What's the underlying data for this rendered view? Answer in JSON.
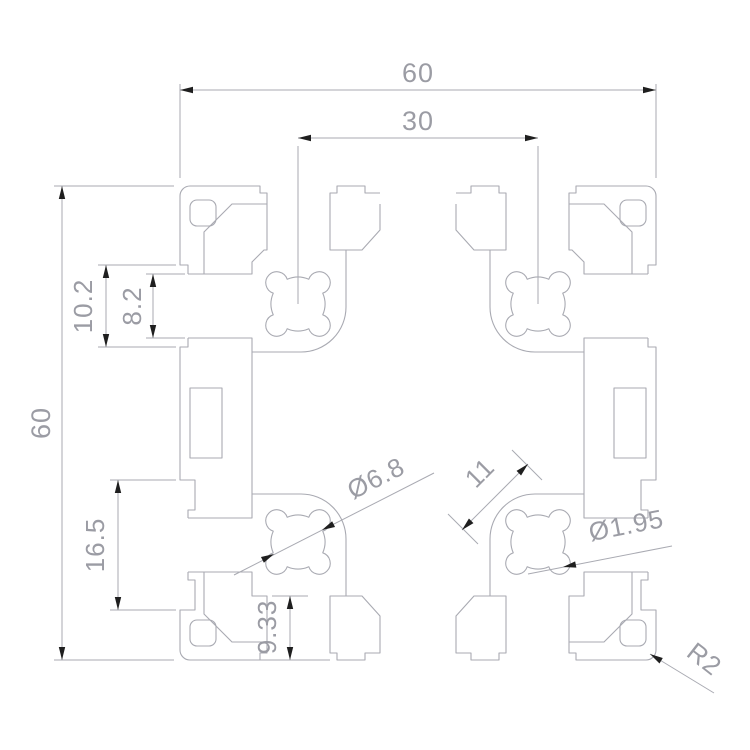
{
  "drawing": {
    "type": "technical-drawing",
    "subject": "aluminum-extrusion-profile-cross-section",
    "colors": {
      "bg": "#ffffff",
      "line": "#a9aab2",
      "text": "#9b9ca4",
      "arrow": "#1f1f1f"
    },
    "dims": {
      "top_overall": {
        "label": "60"
      },
      "top_slot_spacing": {
        "label": "30"
      },
      "left_overall": {
        "label": "60"
      },
      "left_slot_outer": {
        "label": "10.2"
      },
      "left_slot_inner": {
        "label": "8.2"
      },
      "left_side_slot": {
        "label": "16.5"
      },
      "core_hole": {
        "label": "Ø6.8"
      },
      "chamber_width": {
        "label": "11"
      },
      "lobe_hole": {
        "label": "Ø1.95"
      },
      "bottom_web": {
        "label": "9.33"
      },
      "corner_radius": {
        "label": "R2"
      }
    }
  }
}
